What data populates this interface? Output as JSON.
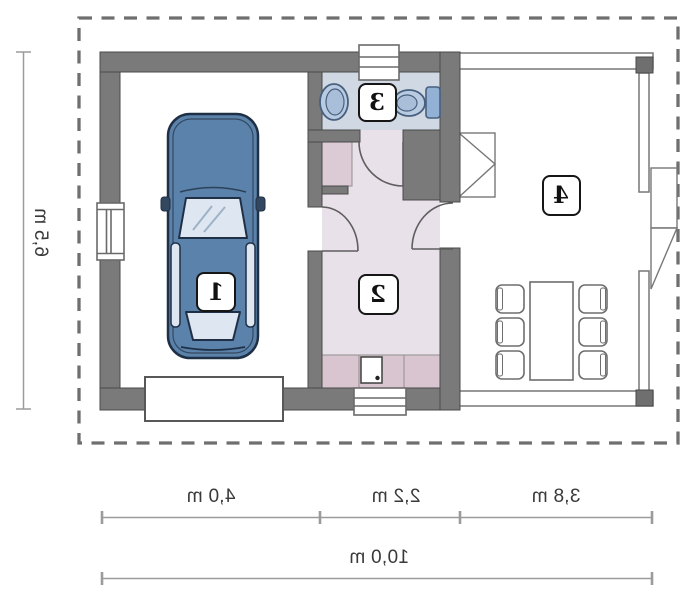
{
  "plan": {
    "title": "garage-floor-plan",
    "text_mirrored": true,
    "rooms": [
      {
        "id": "garage",
        "number": "1"
      },
      {
        "id": "hallway",
        "number": "2"
      },
      {
        "id": "bathroom",
        "number": "3"
      },
      {
        "id": "terrace",
        "number": "4"
      }
    ],
    "dimensions": {
      "left_vertical": "6,5 m",
      "bottom_segments": [
        "4,0 m",
        "2,2 m",
        "3,8 m"
      ],
      "bottom_total": "10,0 m"
    },
    "symbols": {
      "car": "car-top-view-icon",
      "sink": "washbasin-icon",
      "toilet": "toilet-icon",
      "dining": "table-with-six-chairs-icon",
      "doors": "door-swing-arc-icon",
      "windows": "window-icon",
      "garage_door": "garage-door-icon",
      "boundary": "dashed-site-boundary"
    },
    "colors": {
      "wall": "#7a7a7a",
      "wall_edge": "#4a4a4a",
      "bathroom_floor": "#cfd8e3",
      "hallway_floor": "#e9e1e9",
      "cabinet_mauve": "#d8c5cf",
      "closet_mauve": "#dccad4",
      "fixture_blue": "#b9cbe0",
      "fixture_blue_dark": "#93b1d4",
      "car_body": "#5b82aa",
      "car_glass": "#dde6f1",
      "dimension_line": "#9b9b9b",
      "dashed_boundary": "#6f6f6f",
      "background": "#ffffff"
    }
  }
}
